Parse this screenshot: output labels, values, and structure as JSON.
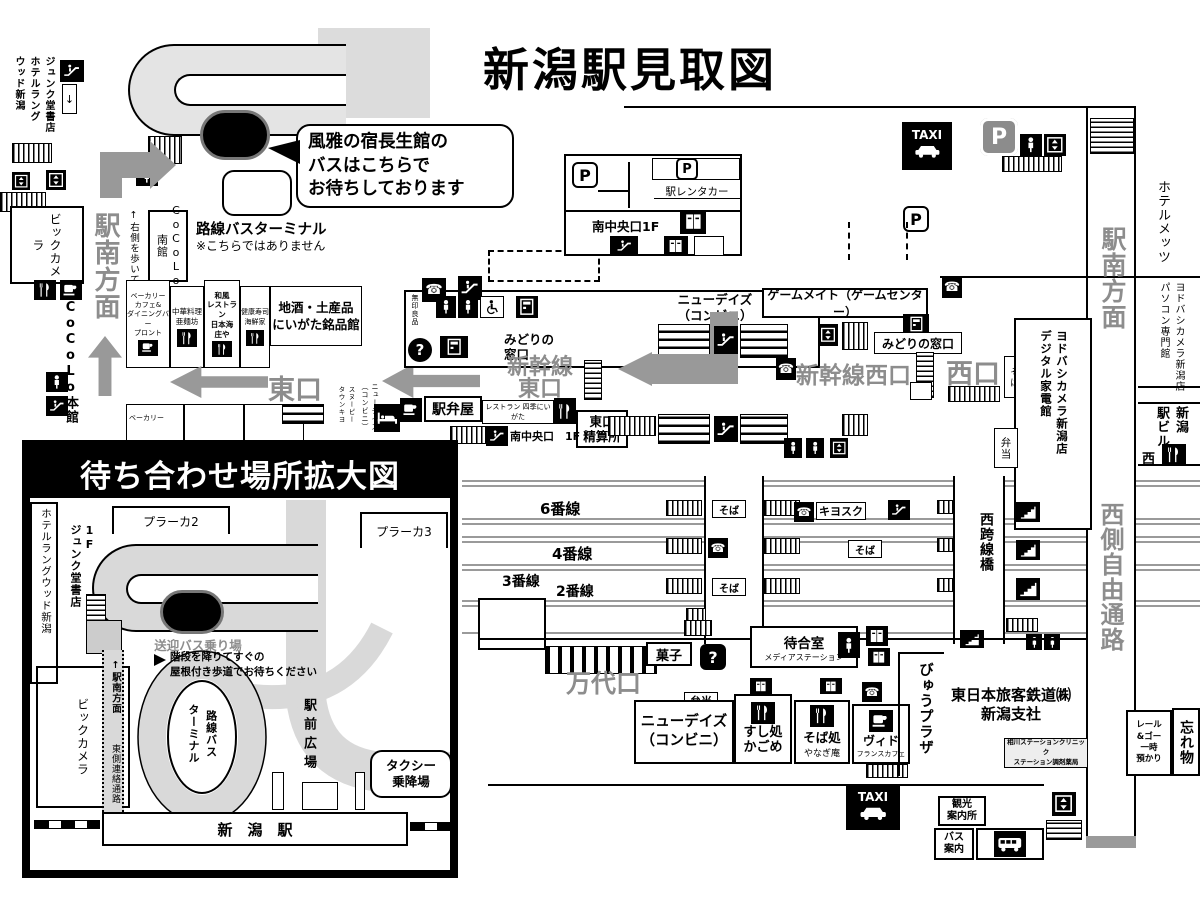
{
  "title": "新潟駅見取図",
  "icons": {
    "phone": "☎",
    "parking": "P",
    "question": "?",
    "taxi": "TAXI",
    "down_arrow": "↓"
  },
  "callout": {
    "text": "風雅の宿長生館の\nバスはこちらで\nお待ちしております"
  },
  "top_left": {
    "junkudo_hotel": "ジュンク堂書店\nホテルラング\nウッド新潟",
    "bus_terminal_title": "路線バスターミナル",
    "bus_terminal_sub": "※こちらではありません",
    "cocolo_minami": "CoCoLo\n南館",
    "ekinan": "駅南方面",
    "walk_note": "↑右側を歩いてください↑",
    "biccamera": "ビックカメラ"
  },
  "left": {
    "cocolo_honkan": "CoCoLo本館",
    "pronto": "ベーカリー\nカフェ&\nダイニングバー\nプロント",
    "chuka": "中華料理\n亜麺坊",
    "shoya": "和風\nレストラン\n日本海\n庄や",
    "kaisenya": "健康寿司\n海鮮家",
    "meihinkan": "地酒・土産品\nにいがた銘品館",
    "bakery": "ベーカリー",
    "snoopy": "スヌーピー\nタウンキヨ",
    "newdays_v": "ニューデイズ\n（コンビニ）",
    "higashiguchi": "東口"
  },
  "concourse": {
    "muji": "無印良品",
    "midori_e": "みどりの\n窓口",
    "shinkansen_e": "新幹線\n東口",
    "newdays": "ニューデイズ\n（コンビニ）",
    "gamemate": "ゲームメイト（ゲームセンター）",
    "midori_w": "みどりの窓口",
    "shinkansen_w": "新幹線西口",
    "nishiguchi": "西口",
    "ekibenya": "駅弁屋",
    "shiki": "レストラン 四季にいがた",
    "seisanjo": "東口\n精算所",
    "minamichuo": "南中央口　1F",
    "soba": "そば",
    "yodobashi_d": "ヨドバシカメラ新潟店\nデジタル家電館",
    "bento": "弁当"
  },
  "north": {
    "rentacar": "駅レンタカー",
    "minamichuo_1f": "南中央口1F"
  },
  "platforms": {
    "p6": "6番線",
    "p4": "4番線",
    "p3": "3番線",
    "p2": "2番線",
    "p1": "1番線",
    "kiosk": "キヨスク",
    "soba": "そば",
    "kosenkyo": "西跨線橋"
  },
  "mandai": {
    "exit": "万代口",
    "kashi": "菓子",
    "waiting": "待合室",
    "media": "メディアステーション",
    "bento": "弁当",
    "newdays": "ニューデイズ\n（コンビニ）",
    "sushi": "すし処\nかごめ",
    "sobadokoro": "そば処",
    "yanagian": "やなぎ庵",
    "vie": "ヴィド",
    "vie_sub": "フランスカフェ",
    "viewplaza": "びゅうプラザ",
    "jr": "東日本旅客鉄道㈱\n新潟支社",
    "clinic": "相川ステーションクリニック\nステーション調剤薬局",
    "kanko": "観光\n案内所",
    "bus_annai": "バス\n案内"
  },
  "right": {
    "mets": "ホテルメッツ",
    "ekinan": "駅南方面",
    "yodobashi_pc": "ヨドバシカメラ新潟店\nパソコン専門館",
    "ekibiru": "新潟\n駅ビル",
    "nishi": "西",
    "passage": "西側自由通路",
    "railgo": "レール\n&ゴー\n一時\n預かり",
    "wasuremono": "忘れ物"
  },
  "inset": {
    "title": "待ち合わせ場所拡大図",
    "langwood": "ホテルラングウッド新潟",
    "junkudo": "1F\nジュンク堂書店",
    "plaka2": "プラーカ2",
    "plaka3": "プラーカ3",
    "shuttle": "送迎バス乗り場",
    "note": "階段を降りてすぐの\n屋根付き歩道でお待ちください",
    "biccamera": "ビックカメラ",
    "ekinan": "↑駅南方面",
    "passage": "東側連絡通路",
    "terminal": "路線バス\nターミナル",
    "hiroba": "駅前広場",
    "taxi_stop": "タクシー\n乗降場",
    "station": "新　潟　駅"
  },
  "colors": {
    "gray_text": "#8d8d8d",
    "road": "#d9d9d9",
    "arrow": "#999999"
  }
}
